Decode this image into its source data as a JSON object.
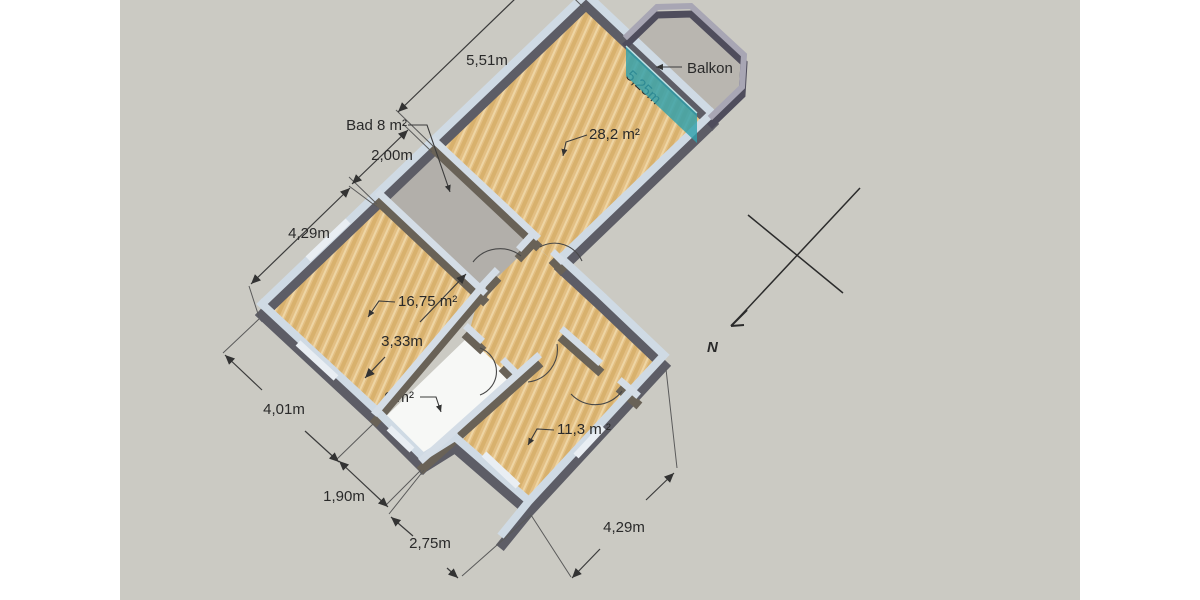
{
  "canvas": {
    "background": "#cbcac3",
    "margin": "#ffffff"
  },
  "room_labels": {
    "bathroom": "Bad 8 m²",
    "living_room": "28,2 m²",
    "bedroom_large": "16,75 m²",
    "bedroom_small": "11,3 m ²",
    "kitchen": "6 m²",
    "balcony": "Balkon"
  },
  "dimensions": {
    "living_width": "5,51m",
    "living_depth": "5,25m",
    "bathroom_width": "2,00m",
    "bedroom_large_width": "4,29m",
    "bedroom_large_depth": "4,01m",
    "kitchen_width": "1,90m",
    "kitchen_depth": "3,33m",
    "bedroom_small_width": "2,75m",
    "bedroom_small_depth": "4,29m"
  },
  "compass": {
    "north_label": "N"
  },
  "colors": {
    "glass": "#2fa0ac",
    "wood": "#e3bf83",
    "wall_top": "#cfdae4",
    "balcony_floor": "#b9b6b0",
    "bath_floor": "#b2afaa",
    "kitchen_floor": "#f7f8f6"
  }
}
